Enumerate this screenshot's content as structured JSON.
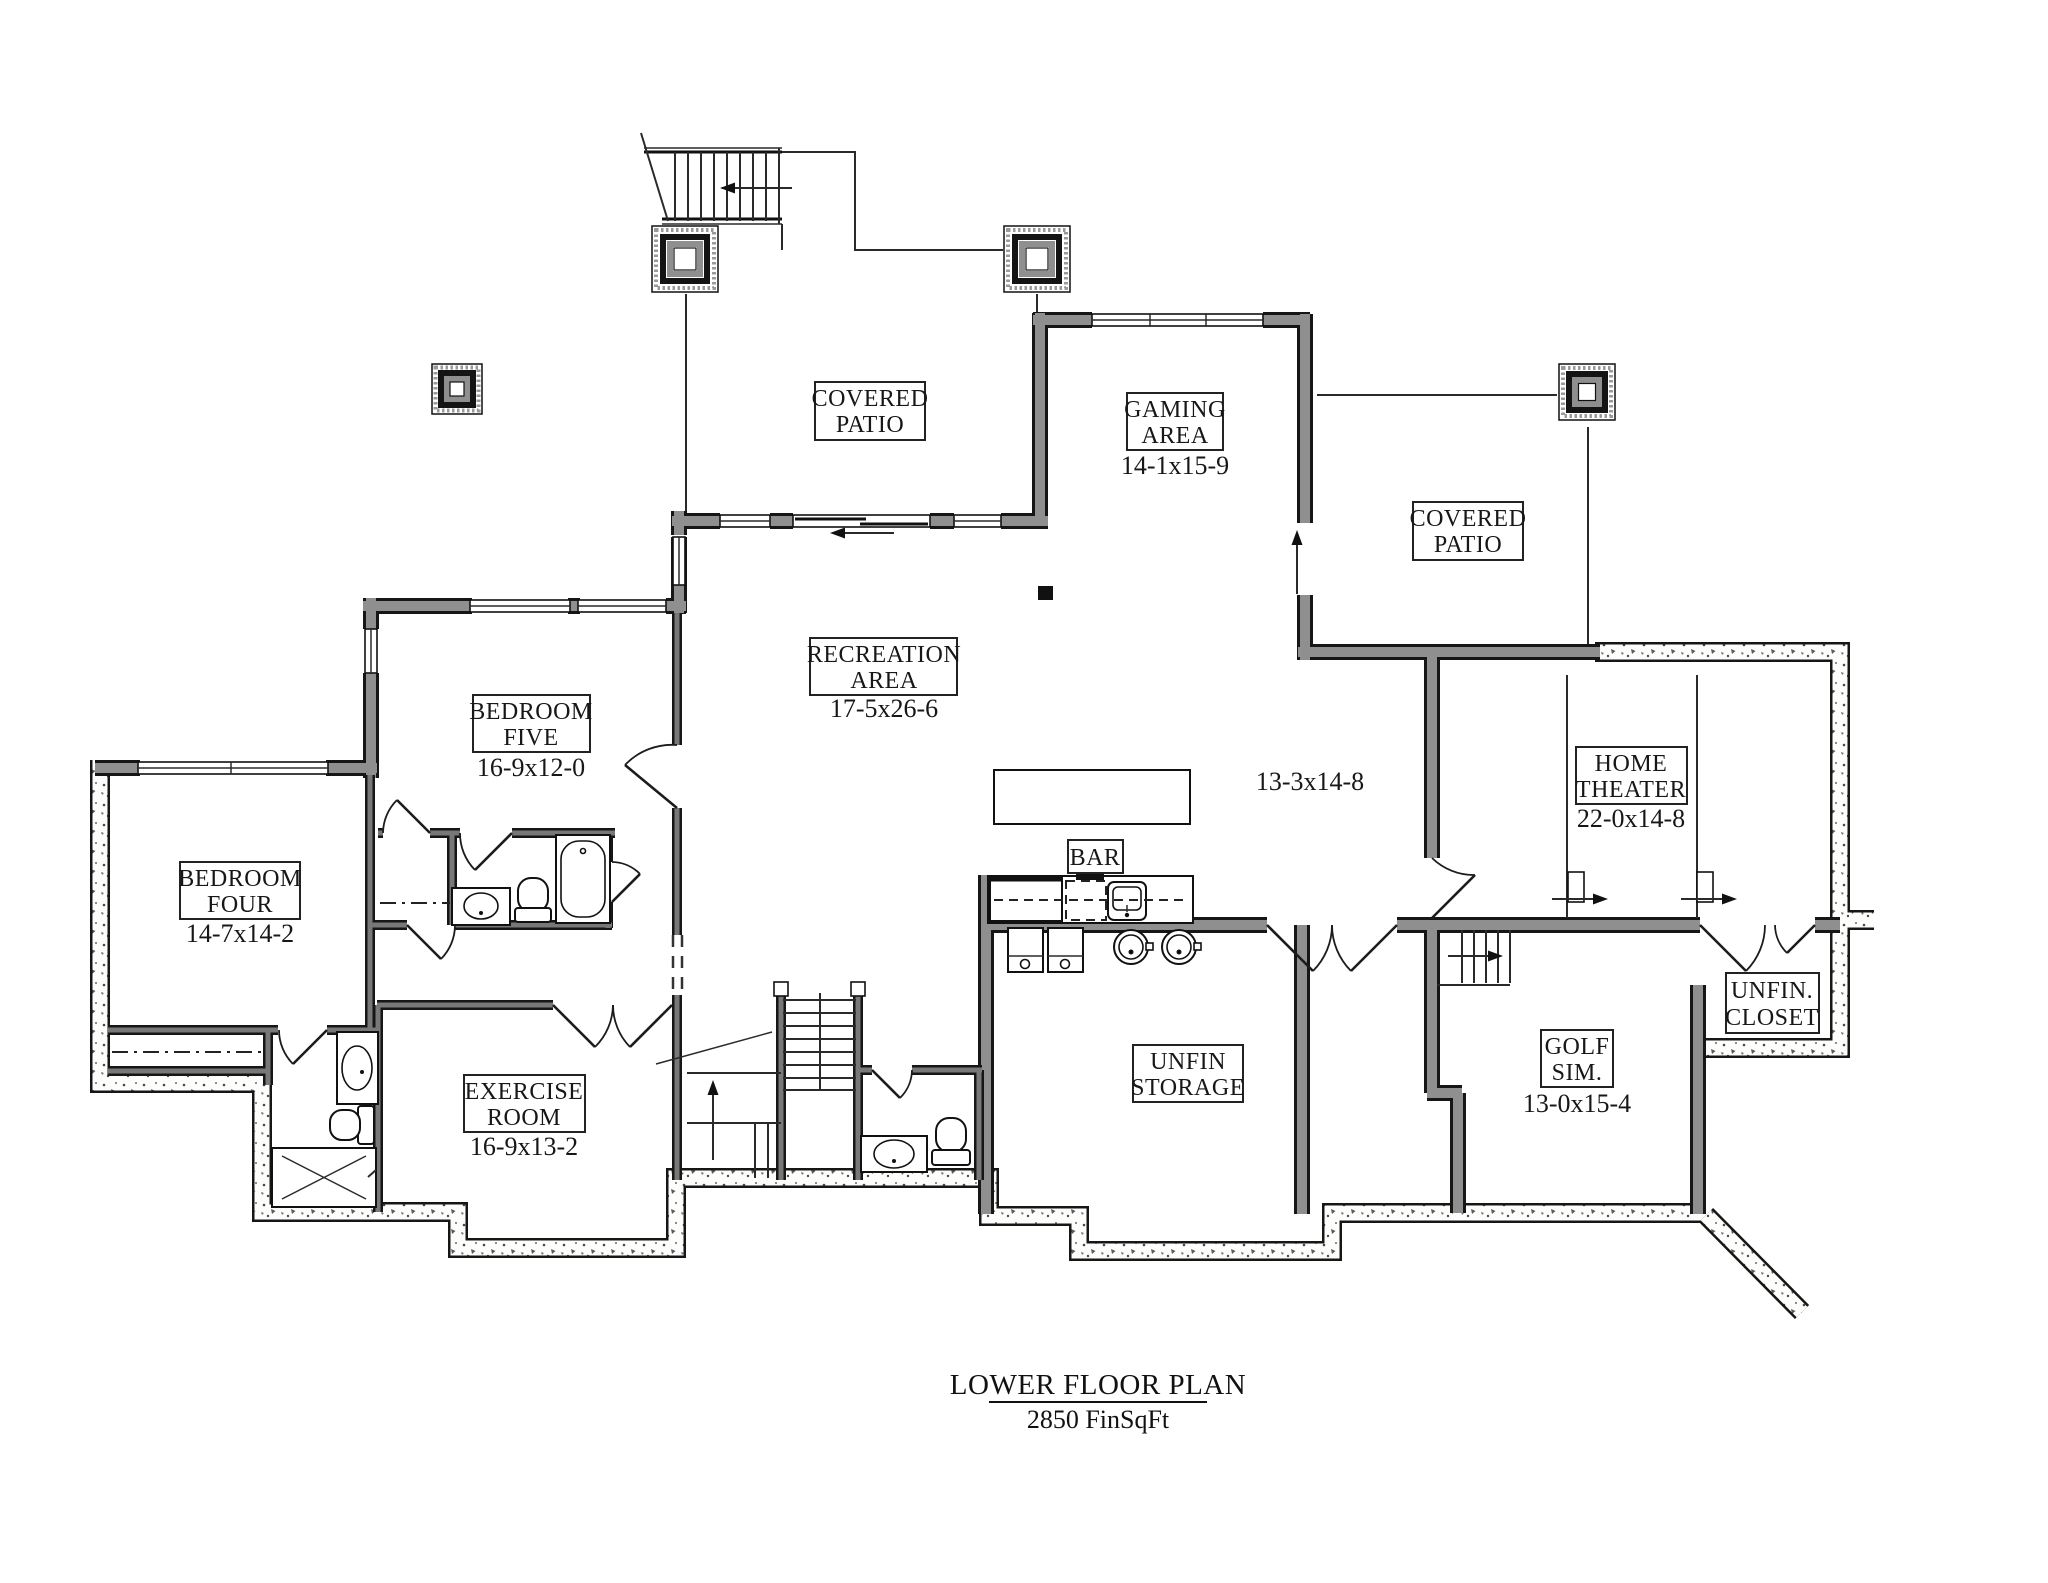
{
  "plan": {
    "title": "LOWER FLOOR PLAN",
    "subtitle": "2850 FinSqFt",
    "rooms": {
      "covered_patio_left": {
        "line1": "COVERED",
        "line2": "PATIO"
      },
      "covered_patio_right": {
        "line1": "COVERED",
        "line2": "PATIO"
      },
      "gaming_area": {
        "line1": "GAMING",
        "line2": "AREA",
        "dims": "14-1x15-9"
      },
      "recreation_area": {
        "line1": "RECREATION",
        "line2": "AREA",
        "dims": "17-5x26-6"
      },
      "bedroom_five": {
        "line1": "BEDROOM",
        "line2": "FIVE",
        "dims": "16-9x12-0"
      },
      "bedroom_four": {
        "line1": "BEDROOM",
        "line2": "FOUR",
        "dims": "14-7x14-2"
      },
      "exercise_room": {
        "line1": "EXERCISE",
        "line2": "ROOM",
        "dims": "16-9x13-2"
      },
      "home_theater": {
        "line1": "HOME",
        "line2": "THEATER",
        "dims": "22-0x14-8"
      },
      "golf_sim": {
        "line1": "GOLF",
        "line2": "SIM.",
        "dims": "13-0x15-4"
      },
      "unfin_storage": {
        "line1": "UNFIN",
        "line2": "STORAGE"
      },
      "unfin_closet": {
        "line1": "UNFIN.",
        "line2": "CLOSET"
      },
      "bar": {
        "line1": "BAR"
      }
    },
    "annotations": {
      "open_area_dims": "13-3x14-8"
    },
    "colors": {
      "framed_wall_gray": "#8f8f8f",
      "line_black": "#161616",
      "paper_white": "#ffffff"
    }
  }
}
